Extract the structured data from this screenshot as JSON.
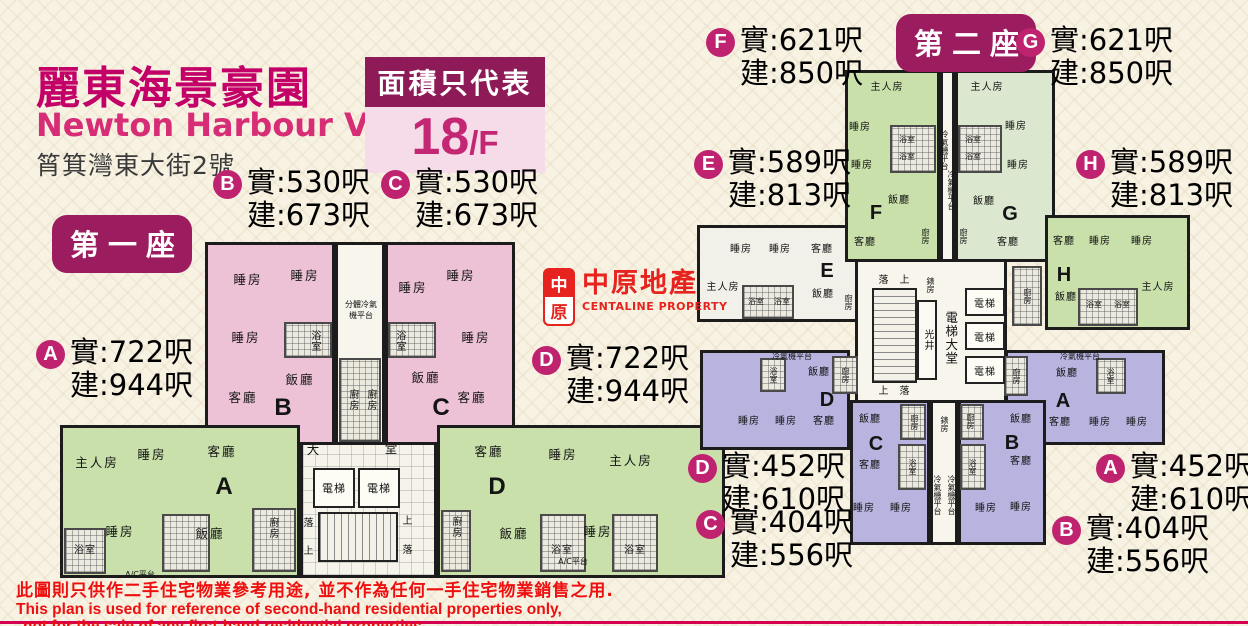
{
  "header": {
    "title_cn": "麗東海景豪園",
    "title_en": "Newton Harbour View",
    "address": "筲箕灣東大街2號",
    "floor_badge": {
      "caption": "面積只代表",
      "floor": "18",
      "suffix": "/F"
    }
  },
  "logo": {
    "seal_top": "中",
    "seal_bottom": "原",
    "name_cn": "中原地產",
    "name_en": "CENTALINE PROPERTY"
  },
  "rooms": {
    "master": "主人房",
    "bed": "睡房",
    "living": "客廳",
    "dining": "飯廳",
    "bath": "浴室",
    "kitchen": "廚房",
    "lobby_l": "大",
    "lobby_r": "堂",
    "lift": "電梯",
    "lift_lobby": "電梯大堂",
    "light_well": "光井",
    "meter": "錶房",
    "up": "上",
    "down": "落",
    "split_ac_1": "分體冷氣",
    "split_ac_2": "機平台",
    "ac_platform": "冷氣機平台",
    "ac_small": "A/C平台"
  },
  "t1": {
    "badge": "第一座",
    "labels": {
      "A": {
        "letter": "A",
        "net": "實:722呎",
        "gross": "建:944呎"
      },
      "B": {
        "letter": "B",
        "net": "實:530呎",
        "gross": "建:673呎"
      },
      "C": {
        "letter": "C",
        "net": "實:530呎",
        "gross": "建:673呎"
      },
      "D": {
        "letter": "D",
        "net": "實:722呎",
        "gross": "建:944呎"
      }
    }
  },
  "t2": {
    "badge": "第二座",
    "labels": {
      "F": {
        "letter": "F",
        "net": "實:621呎",
        "gross": "建:850呎"
      },
      "G": {
        "letter": "G",
        "net": "實:621呎",
        "gross": "建:850呎"
      },
      "E": {
        "letter": "E",
        "net": "實:589呎",
        "gross": "建:813呎"
      },
      "H": {
        "letter": "H",
        "net": "實:589呎",
        "gross": "建:813呎"
      },
      "D": {
        "letter": "D",
        "net": "實:452呎",
        "gross": "建:610呎"
      },
      "A": {
        "letter": "A",
        "net": "實:452呎",
        "gross": "建:610呎"
      },
      "C": {
        "letter": "C",
        "net": "實:404呎",
        "gross": "建:556呎"
      },
      "B": {
        "letter": "B",
        "net": "實:404呎",
        "gross": "建:556呎"
      }
    }
  },
  "disclaimer": {
    "line1": "此圖則只供作二手住宅物業參考用途, 並不作為任何一手住宅物業銷售之用.",
    "line2": "This plan is used for reference of second-hand residential properties only,",
    "line3": "not for the sale of any first-hand residential properties."
  }
}
